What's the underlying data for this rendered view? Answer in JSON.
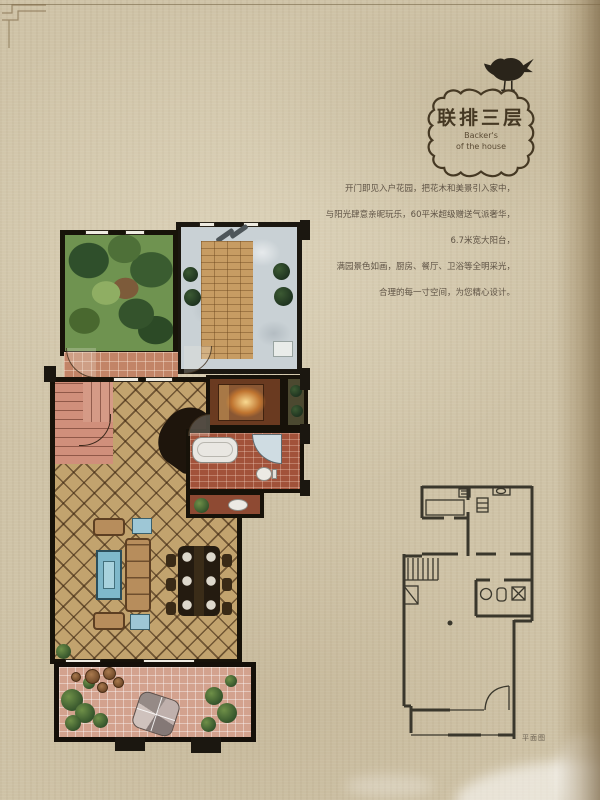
{
  "page": {
    "background_color": "#cfc3a7",
    "right_edge_color": "#7a6544"
  },
  "badge": {
    "title": "联排三层",
    "subtitle_line1": "Backer's",
    "subtitle_line2": "of the house",
    "frame_color": "#453823",
    "bird_color": "#2a241a"
  },
  "description": {
    "text_color": "#5f5345",
    "lines": [
      "开门即见入户花园，把花木和美景引入家中，",
      "与阳光肆意亲昵玩乐，60平米超级赠送气派奢华，",
      "6.7米宽大阳台，",
      "满园景色如画，厨房、餐厅、卫浴等全明采光，",
      "合理的每一寸空间，为您精心设计。"
    ]
  },
  "floor_plan": {
    "wall_color": "#1b1710",
    "living_floor_color": "#c2a36e",
    "terrace_floor_color": "#d3a28e",
    "patio_floor_color": "#c9d1d5",
    "garden_color": "#6f9350",
    "stairs_color": "#d08f7b",
    "bath_floor_color": "#a2523a",
    "rug_color": "#7fb8ca"
  },
  "key_plan": {
    "line_color": "#3a372c",
    "caption": "平面图"
  }
}
